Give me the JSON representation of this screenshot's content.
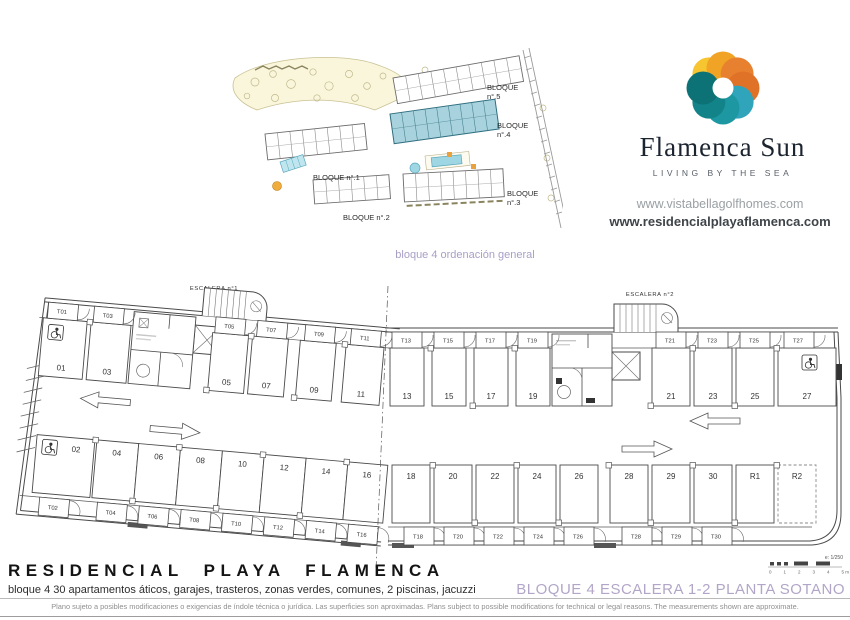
{
  "brand": {
    "name": "Flamenca Sun",
    "tagline": "LIVING BY THE SEA",
    "websites": [
      "www.vistabellagolfhomes.com",
      "www.residencialplayaflamenca.com"
    ],
    "logo_petal_colors": [
      "#F6C52F",
      "#F0A325",
      "#E8812F",
      "#E07228",
      "#2FA4BA",
      "#1D98A3",
      "#128489",
      "#0C7276"
    ]
  },
  "site_plan": {
    "caption": "bloque 4 ordenación general",
    "caption_color": "#A99FC6",
    "highlight_fill": "#A8D3DE",
    "blocks": [
      {
        "label": "BLOQUE",
        "sub": "n°.5"
      },
      {
        "label": "BLOQUE",
        "sub": "n°.4"
      },
      {
        "label": "BLOQUE",
        "sub": "n°.3"
      },
      {
        "label": "BLOQUE n°.1",
        "sub": ""
      },
      {
        "label": "BLOQUE n°.2",
        "sub": ""
      }
    ]
  },
  "floor_plan": {
    "stairs": [
      "ESCALERA n°1",
      "ESCALERA n°2"
    ],
    "top_left": [
      {
        "num": "01",
        "trastero": "T01",
        "accessible": true
      },
      {
        "num": "03",
        "trastero": "T03"
      },
      {
        "num": "05",
        "trastero": "T05"
      },
      {
        "num": "07",
        "trastero": "T07"
      },
      {
        "num": "09",
        "trastero": "T09"
      },
      {
        "num": "11",
        "trastero": "T11"
      }
    ],
    "top_right": [
      {
        "num": "13",
        "trastero": "T13"
      },
      {
        "num": "15",
        "trastero": "T15"
      },
      {
        "num": "17",
        "trastero": "T17"
      },
      {
        "num": "19",
        "trastero": "T19"
      },
      {
        "num": "21",
        "trastero": "T21"
      },
      {
        "num": "23",
        "trastero": "T23"
      },
      {
        "num": "25",
        "trastero": "T25"
      },
      {
        "num": "27",
        "trastero": "T27",
        "accessible": true
      }
    ],
    "bottom_left": [
      {
        "num": "02",
        "trastero": "T02",
        "accessible": true
      },
      {
        "num": "04",
        "trastero": "T04"
      },
      {
        "num": "06",
        "trastero": "T06"
      },
      {
        "num": "08",
        "trastero": "T08"
      },
      {
        "num": "10",
        "trastero": "T10"
      },
      {
        "num": "12",
        "trastero": "T12"
      },
      {
        "num": "14",
        "trastero": "T14"
      },
      {
        "num": "16",
        "trastero": "T16"
      }
    ],
    "bottom_right": [
      {
        "num": "18",
        "trastero": "T18"
      },
      {
        "num": "20",
        "trastero": "T20"
      },
      {
        "num": "22",
        "trastero": "T22"
      },
      {
        "num": "24",
        "trastero": "T24"
      },
      {
        "num": "26",
        "trastero": "T26"
      },
      {
        "num": "28",
        "trastero": "T28"
      },
      {
        "num": "29",
        "trastero": "T29"
      },
      {
        "num": "30",
        "trastero": "T30"
      },
      {
        "num": "R1",
        "trastero": null
      },
      {
        "num": "R2",
        "trastero": null,
        "dashed": true
      }
    ],
    "scale": {
      "ratio": "e: 1/250",
      "ticks": [
        "0",
        "1",
        "2",
        "3",
        "4",
        "5 m"
      ]
    }
  },
  "footer": {
    "title": "RESIDENCIAL PLAYA FLAMENCA",
    "subtitle": "bloque 4 30 apartamentos áticos, garajes, trasteros, zonas verdes, comunes, 2 piscinas, jacuzzi",
    "sheet_title": "BLOQUE 4 ESCALERA 1-2 PLANTA SOTANO",
    "sheet_title_color": "#B2A6C8",
    "disclaimer": "Plano sujeto a posibles modificaciones o exigencias de índole técnica o jurídica. Las superficies son aproximadas. Plans subject to possible modifications for technical or legal reasons. The measurements shown are approximate."
  }
}
